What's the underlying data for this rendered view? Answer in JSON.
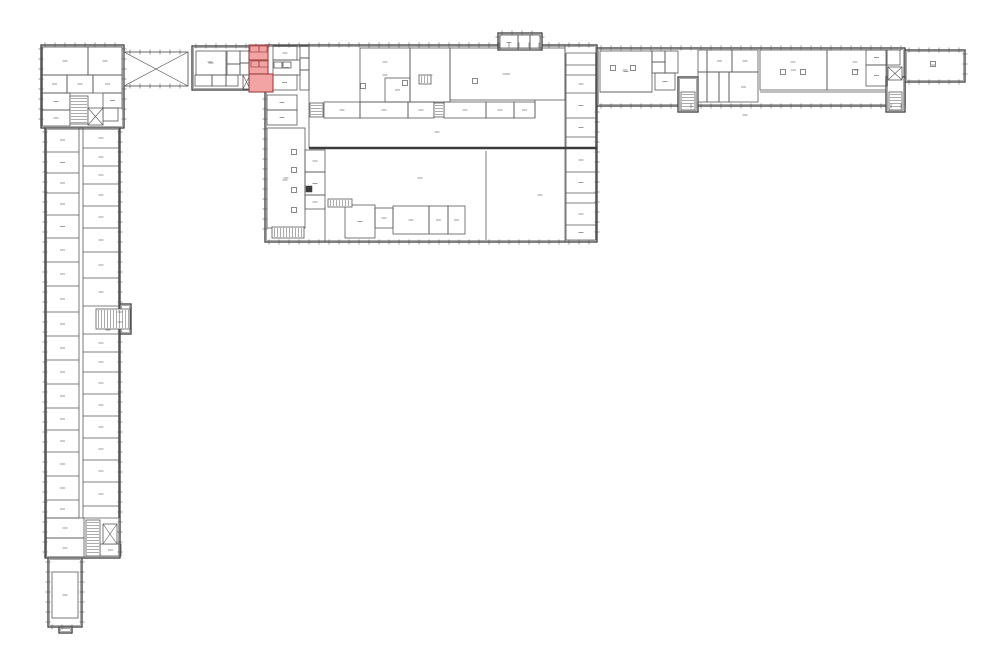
{
  "meta": {
    "kind": "architectural-floor-plan",
    "canvas": {
      "width": 1000,
      "height": 665,
      "background": "#ffffff"
    }
  },
  "plan": {
    "style": {
      "wall": "#3c3c3c",
      "thin": "#585858",
      "faint": "#8f8f8f",
      "label_dash": "#9b9b9b",
      "outline_width": 1.3,
      "inner_width": 0.5,
      "thin_width": 0.8,
      "thick_width": 2.4,
      "tick_step": 10,
      "highlight_fill": "#f2a3a3",
      "highlight_stroke": "#9c4242"
    },
    "outlines": [
      {
        "name": "left-wing-top-block",
        "x": 41,
        "y": 45,
        "w": 83,
        "h": 83,
        "ticks": [
          "top",
          "left",
          "right"
        ]
      },
      {
        "name": "left-wing-main",
        "x": 45,
        "y": 128,
        "w": 75,
        "h": 430,
        "ticks": [
          "left",
          "right"
        ]
      },
      {
        "name": "mid-stair-landing",
        "x": 120,
        "y": 304,
        "w": 11,
        "h": 30,
        "ticks": []
      },
      {
        "name": "left-wing-south-annex",
        "x": 48,
        "y": 558,
        "w": 34,
        "h": 69,
        "ticks": [
          "left",
          "right",
          "bottom"
        ]
      },
      {
        "name": "south-annex-stub",
        "x": 59,
        "y": 627,
        "w": 13,
        "h": 6,
        "ticks": []
      },
      {
        "name": "entry-block",
        "x": 192,
        "y": 46,
        "w": 73,
        "h": 44,
        "ticks": [
          "top"
        ]
      },
      {
        "name": "central-building",
        "x": 265,
        "y": 45,
        "w": 332,
        "h": 197,
        "ticks": [
          "top",
          "left",
          "bottom"
        ]
      },
      {
        "name": "north-annex",
        "x": 498,
        "y": 33,
        "w": 44,
        "h": 17,
        "ticks": [
          "top",
          "left",
          "right"
        ]
      },
      {
        "name": "east-wing",
        "x": 597,
        "y": 48,
        "w": 308,
        "h": 58,
        "ticks": [
          "top",
          "bottom"
        ]
      },
      {
        "name": "east-wing-extension",
        "x": 905,
        "y": 50,
        "w": 60,
        "h": 32,
        "ticks": [
          "top",
          "right",
          "bottom"
        ]
      },
      {
        "name": "east-stair-tower-1",
        "x": 678,
        "y": 77,
        "w": 20,
        "h": 35,
        "ticks": []
      },
      {
        "name": "east-stair-tower-2",
        "x": 886,
        "y": 77,
        "w": 19,
        "h": 35,
        "ticks": []
      }
    ],
    "braces": [
      {
        "x": 124,
        "y": 52,
        "w": 64,
        "h": 34
      }
    ],
    "thick_walls": [
      [
        309,
        148,
        597,
        148
      ]
    ],
    "walls": [
      [
        309,
        45,
        309,
        148
      ],
      [
        565,
        45,
        565,
        242
      ],
      [
        486,
        151,
        486,
        240
      ],
      [
        535,
        100,
        535,
        118
      ],
      [
        325,
        207,
        325,
        242
      ],
      [
        600,
        92,
        652,
        92
      ],
      [
        760,
        92,
        886,
        92
      ]
    ],
    "tick_lines": [
      {
        "axis": "v",
        "at": 597,
        "from": 108,
        "to": 240
      },
      {
        "axis": "h",
        "at": 52,
        "from": 126,
        "to": 186
      },
      {
        "axis": "h",
        "at": 86,
        "from": 126,
        "to": 186
      }
    ],
    "rooms": [
      {
        "x": 42,
        "y": 47,
        "w": 46,
        "h": 28
      },
      {
        "x": 88,
        "y": 47,
        "w": 34,
        "h": 28
      },
      {
        "x": 42,
        "y": 75,
        "w": 25,
        "h": 18
      },
      {
        "x": 67,
        "y": 75,
        "w": 26,
        "h": 18
      },
      {
        "x": 93,
        "y": 75,
        "w": 29,
        "h": 18
      },
      {
        "x": 42,
        "y": 93,
        "w": 28,
        "h": 17
      },
      {
        "x": 42,
        "y": 110,
        "w": 28,
        "h": 16
      },
      {
        "x": 103,
        "y": 93,
        "w": 19,
        "h": 15
      },
      {
        "x": 103,
        "y": 108,
        "w": 15,
        "h": 13
      },
      {
        "x": 46,
        "y": 518,
        "w": 38,
        "h": 20
      },
      {
        "x": 46,
        "y": 538,
        "w": 38,
        "h": 20
      },
      {
        "x": 100,
        "y": 544,
        "w": 21,
        "h": 12
      },
      {
        "x": 52,
        "y": 572,
        "w": 26,
        "h": 46
      },
      {
        "x": 196,
        "y": 51,
        "w": 30,
        "h": 24
      },
      {
        "x": 227,
        "y": 51,
        "w": 13,
        "h": 13
      },
      {
        "x": 227,
        "y": 64,
        "w": 13,
        "h": 11
      },
      {
        "x": 195,
        "y": 75,
        "w": 17,
        "h": 11
      },
      {
        "x": 212,
        "y": 75,
        "w": 14,
        "h": 11
      },
      {
        "x": 226,
        "y": 75,
        "w": 12,
        "h": 11
      },
      {
        "x": 240,
        "y": 51,
        "w": 9,
        "h": 12
      },
      {
        "x": 240,
        "y": 63,
        "w": 9,
        "h": 12
      },
      {
        "x": 273,
        "y": 46,
        "w": 24,
        "h": 14
      },
      {
        "x": 273,
        "y": 60,
        "w": 27,
        "h": 15
      },
      {
        "x": 272,
        "y": 75,
        "w": 25,
        "h": 15
      },
      {
        "x": 274,
        "y": 62,
        "w": 8,
        "h": 6
      },
      {
        "x": 283,
        "y": 62,
        "w": 8,
        "h": 6
      },
      {
        "x": 300,
        "y": 46,
        "w": 9,
        "h": 12
      },
      {
        "x": 300,
        "y": 58,
        "w": 9,
        "h": 12
      },
      {
        "x": 300,
        "y": 70,
        "w": 9,
        "h": 20
      },
      {
        "x": 267,
        "y": 95,
        "w": 30,
        "h": 15
      },
      {
        "x": 267,
        "y": 110,
        "w": 30,
        "h": 15
      },
      {
        "x": 267,
        "y": 128,
        "w": 38,
        "h": 100
      },
      {
        "x": 305,
        "y": 150,
        "w": 20,
        "h": 22
      },
      {
        "x": 305,
        "y": 172,
        "w": 20,
        "h": 23
      },
      {
        "x": 305,
        "y": 195,
        "w": 20,
        "h": 14
      },
      {
        "x": 360,
        "y": 48,
        "w": 50,
        "h": 54
      },
      {
        "x": 385,
        "y": 78,
        "w": 25,
        "h": 24
      },
      {
        "x": 410,
        "y": 48,
        "w": 40,
        "h": 54
      },
      {
        "x": 450,
        "y": 48,
        "w": 115,
        "h": 52
      },
      {
        "x": 324,
        "y": 102,
        "w": 36,
        "h": 16
      },
      {
        "x": 360,
        "y": 102,
        "w": 48,
        "h": 16
      },
      {
        "x": 408,
        "y": 102,
        "w": 26,
        "h": 16
      },
      {
        "x": 444,
        "y": 102,
        "w": 42,
        "h": 16
      },
      {
        "x": 486,
        "y": 102,
        "w": 28,
        "h": 16
      },
      {
        "x": 514,
        "y": 102,
        "w": 21,
        "h": 16
      },
      {
        "x": 345,
        "y": 205,
        "w": 30,
        "h": 33
      },
      {
        "x": 375,
        "y": 208,
        "w": 18,
        "h": 20
      },
      {
        "x": 393,
        "y": 206,
        "w": 36,
        "h": 28
      },
      {
        "x": 429,
        "y": 206,
        "w": 19,
        "h": 28
      },
      {
        "x": 448,
        "y": 206,
        "w": 17,
        "h": 28
      },
      {
        "x": 500,
        "y": 35,
        "w": 18,
        "h": 15
      },
      {
        "x": 518,
        "y": 35,
        "w": 12,
        "h": 15
      },
      {
        "x": 530,
        "y": 35,
        "w": 10,
        "h": 15
      },
      {
        "x": 600,
        "y": 51,
        "w": 52,
        "h": 41
      },
      {
        "x": 652,
        "y": 51,
        "w": 13,
        "h": 11
      },
      {
        "x": 652,
        "y": 62,
        "w": 13,
        "h": 11
      },
      {
        "x": 665,
        "y": 51,
        "w": 13,
        "h": 22
      },
      {
        "x": 655,
        "y": 73,
        "w": 20,
        "h": 17
      },
      {
        "x": 698,
        "y": 50,
        "w": 9,
        "h": 22
      },
      {
        "x": 707,
        "y": 50,
        "w": 25,
        "h": 22
      },
      {
        "x": 732,
        "y": 50,
        "w": 26,
        "h": 22
      },
      {
        "x": 698,
        "y": 72,
        "w": 9,
        "h": 30
      },
      {
        "x": 707,
        "y": 72,
        "w": 12,
        "h": 30
      },
      {
        "x": 719,
        "y": 72,
        "w": 10,
        "h": 30
      },
      {
        "x": 729,
        "y": 72,
        "w": 29,
        "h": 30
      },
      {
        "x": 760,
        "y": 50,
        "w": 67,
        "h": 40
      },
      {
        "x": 827,
        "y": 50,
        "w": 59,
        "h": 40
      },
      {
        "x": 866,
        "y": 50,
        "w": 21,
        "h": 15
      },
      {
        "x": 887,
        "y": 50,
        "w": 13,
        "h": 15
      },
      {
        "x": 866,
        "y": 65,
        "w": 21,
        "h": 21
      }
    ],
    "stacks": [
      {
        "x": 46,
        "w": 33,
        "ys": [
          128,
          152,
          173,
          193,
          215,
          238,
          262,
          286,
          312,
          336,
          360,
          384,
          408,
          430,
          452,
          476,
          500,
          518
        ]
      },
      {
        "x": 83,
        "w": 36,
        "ys": [
          128,
          148,
          166,
          184,
          206,
          228,
          252,
          278,
          306,
          334,
          352,
          372,
          394,
          416,
          438,
          460,
          482,
          506,
          518
        ]
      },
      {
        "x": 566,
        "w": 30,
        "ys": [
          53,
          65,
          75,
          93,
          118,
          137,
          148,
          172,
          193,
          203,
          225,
          240
        ]
      }
    ],
    "stairs": [
      {
        "x": 70,
        "y": 96,
        "w": 18,
        "h": 28,
        "dir": "v"
      },
      {
        "x": 96,
        "y": 309,
        "w": 34,
        "h": 20,
        "dir": "h"
      },
      {
        "x": 86,
        "y": 520,
        "w": 14,
        "h": 36,
        "dir": "v"
      },
      {
        "x": 272,
        "y": 227,
        "w": 32,
        "h": 11,
        "dir": "h"
      },
      {
        "x": 310,
        "y": 103,
        "w": 13,
        "h": 14,
        "dir": "v"
      },
      {
        "x": 434,
        "y": 103,
        "w": 10,
        "h": 14,
        "dir": "v"
      },
      {
        "x": 328,
        "y": 199,
        "w": 24,
        "h": 8,
        "dir": "h"
      },
      {
        "x": 419,
        "y": 75,
        "w": 12,
        "h": 9,
        "dir": "h"
      },
      {
        "x": 681,
        "y": 92,
        "w": 14,
        "h": 18,
        "dir": "v"
      },
      {
        "x": 889,
        "y": 92,
        "w": 13,
        "h": 18,
        "dir": "v"
      }
    ],
    "xboxes": [
      {
        "x": 88,
        "y": 108,
        "w": 15,
        "h": 17
      },
      {
        "x": 103,
        "y": 524,
        "w": 14,
        "h": 20
      },
      {
        "x": 243,
        "y": 75,
        "w": 7,
        "h": 14
      },
      {
        "x": 888,
        "y": 67,
        "w": 14,
        "h": 13
      }
    ],
    "column_marks": [
      [
        294,
        152
      ],
      [
        294,
        170
      ],
      [
        294,
        190
      ],
      [
        294,
        210
      ],
      [
        613,
        68
      ],
      [
        633,
        68
      ],
      [
        783,
        72
      ],
      [
        803,
        72
      ],
      [
        855,
        72
      ],
      [
        475,
        81
      ],
      [
        405,
        83
      ],
      [
        363,
        86
      ],
      [
        933,
        64
      ]
    ],
    "filled_squares": [
      [
        306,
        186,
        6,
        6
      ]
    ],
    "label_dashes": [
      [
        437,
        132
      ],
      [
        420,
        178
      ],
      [
        540,
        195
      ],
      [
        285,
        180
      ],
      [
        505,
        74
      ],
      [
        385,
        62
      ],
      [
        625,
        70
      ],
      [
        793,
        62
      ],
      [
        855,
        62
      ],
      [
        933,
        65
      ],
      [
        210,
        62
      ],
      [
        108,
        330
      ],
      [
        745,
        115
      ]
    ],
    "highlight": {
      "name": "selected-rooms",
      "rooms": [
        {
          "x": 249,
          "y": 45,
          "w": 19,
          "h": 15
        },
        {
          "x": 249,
          "y": 60,
          "w": 19,
          "h": 14
        },
        {
          "x": 249,
          "y": 74,
          "w": 24,
          "h": 18
        }
      ],
      "subrects": [
        {
          "x": 250,
          "y": 46,
          "w": 9,
          "h": 6
        },
        {
          "x": 259,
          "y": 46,
          "w": 8,
          "h": 6
        },
        {
          "x": 251,
          "y": 61,
          "w": 8,
          "h": 6
        },
        {
          "x": 259,
          "y": 61,
          "w": 9,
          "h": 6
        }
      ]
    }
  }
}
